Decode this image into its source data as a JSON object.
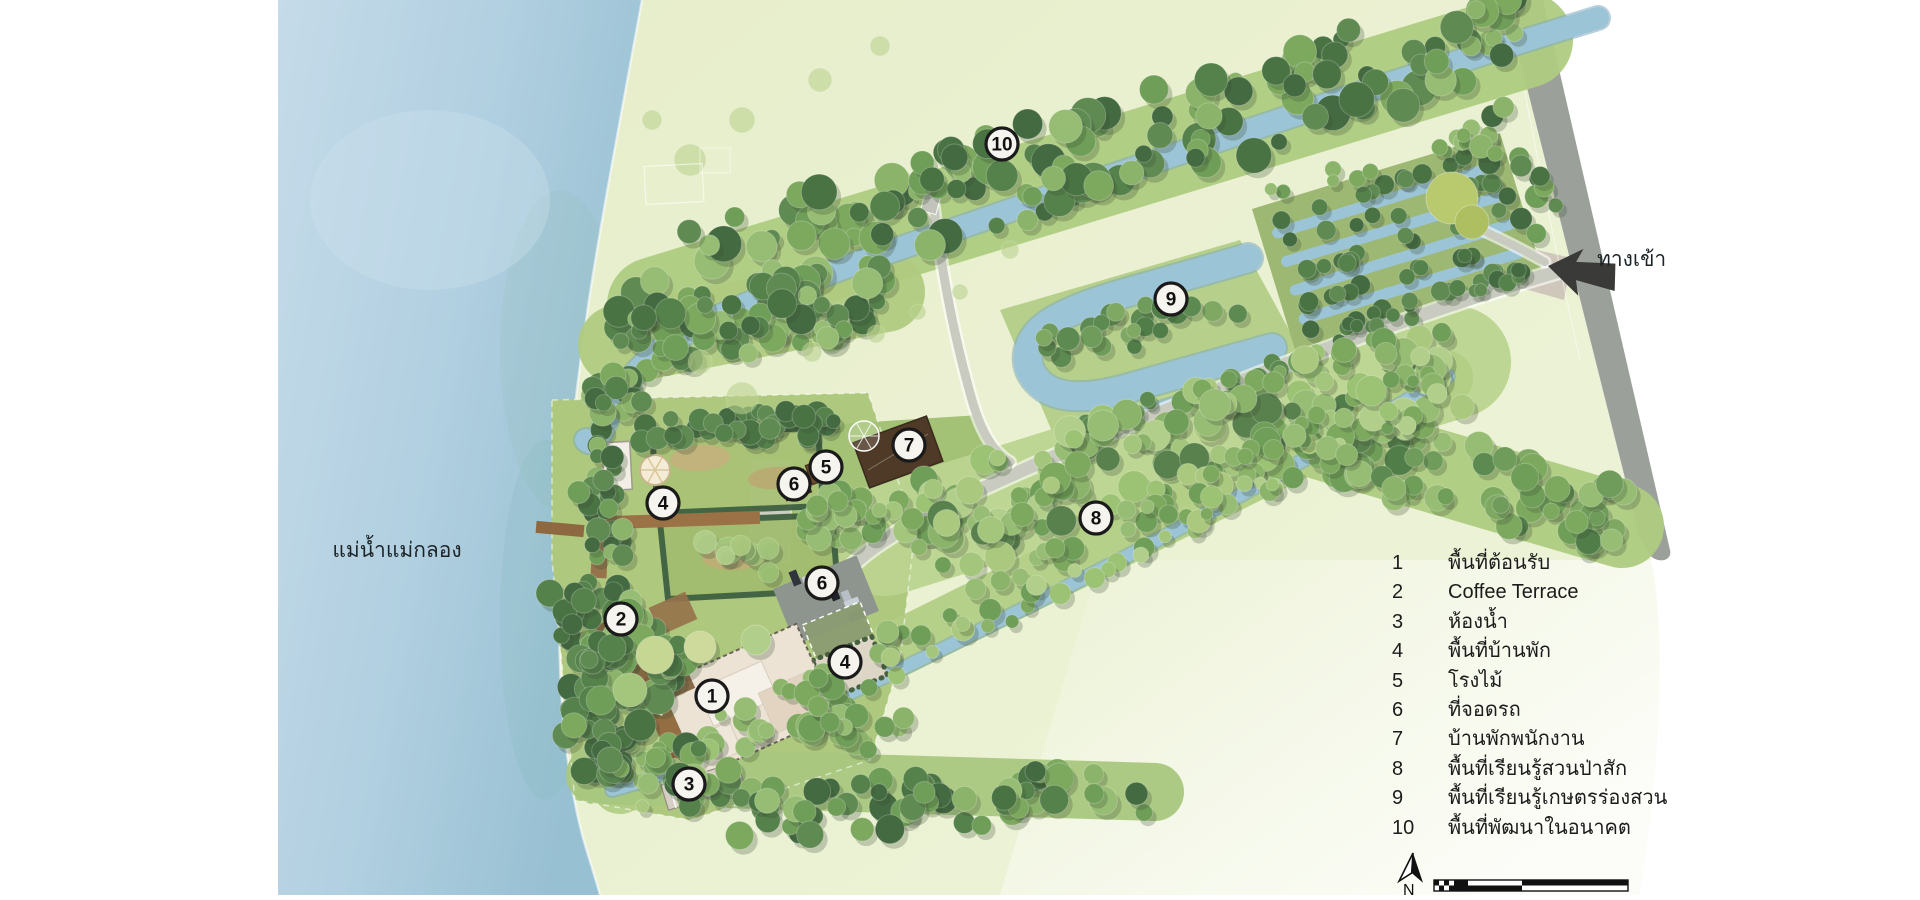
{
  "colors": {
    "river": "#bcd6e6",
    "river_deep": "#9cc2d6",
    "field": "#e9efcd",
    "grass": "#aecb81",
    "canal": "#9cc4d7",
    "canal_edge": "#7fa9bd",
    "path": "#c9cbc0",
    "highway": "#9ba19a",
    "marker_fill": "#f6f4ef",
    "ink": "#1c1c1c",
    "arrow": "#3a3a38"
  },
  "map": {
    "river_label": "แม่น้ำแม่กลอง",
    "entrance_label": "ทางเข้า",
    "north_label": "N",
    "markers": [
      {
        "num": "10",
        "x": 1002,
        "y": 144
      },
      {
        "num": "9",
        "x": 1171,
        "y": 299
      },
      {
        "num": "7",
        "x": 909,
        "y": 445
      },
      {
        "num": "5",
        "x": 826,
        "y": 467
      },
      {
        "num": "6",
        "x": 794,
        "y": 484
      },
      {
        "num": "4",
        "x": 663,
        "y": 503
      },
      {
        "num": "8",
        "x": 1096,
        "y": 518
      },
      {
        "num": "6",
        "x": 822,
        "y": 583
      },
      {
        "num": "2",
        "x": 621,
        "y": 619
      },
      {
        "num": "4",
        "x": 845,
        "y": 662
      },
      {
        "num": "1",
        "x": 712,
        "y": 696
      },
      {
        "num": "3",
        "x": 689,
        "y": 784
      }
    ]
  },
  "legend": {
    "items": [
      {
        "num": "1",
        "label": "พื้นที่ต้อนรับ"
      },
      {
        "num": "2",
        "label": "Coffee Terrace"
      },
      {
        "num": "3",
        "label": "ห้องน้ำ"
      },
      {
        "num": "4",
        "label": "พื้นที่บ้านพัก"
      },
      {
        "num": "5",
        "label": "โรงไม้"
      },
      {
        "num": "6",
        "label": "ที่จอดรถ"
      },
      {
        "num": "7",
        "label": "บ้านพักพนักงาน"
      },
      {
        "num": "8",
        "label": "พื้นที่เรียนรู้สวนป่าสัก"
      },
      {
        "num": "9",
        "label": "พื้นที่เรียนรู้เกษตรร่องสวน"
      },
      {
        "num": "10",
        "label": "พื้นที่พัฒนาในอนาคต"
      }
    ]
  }
}
